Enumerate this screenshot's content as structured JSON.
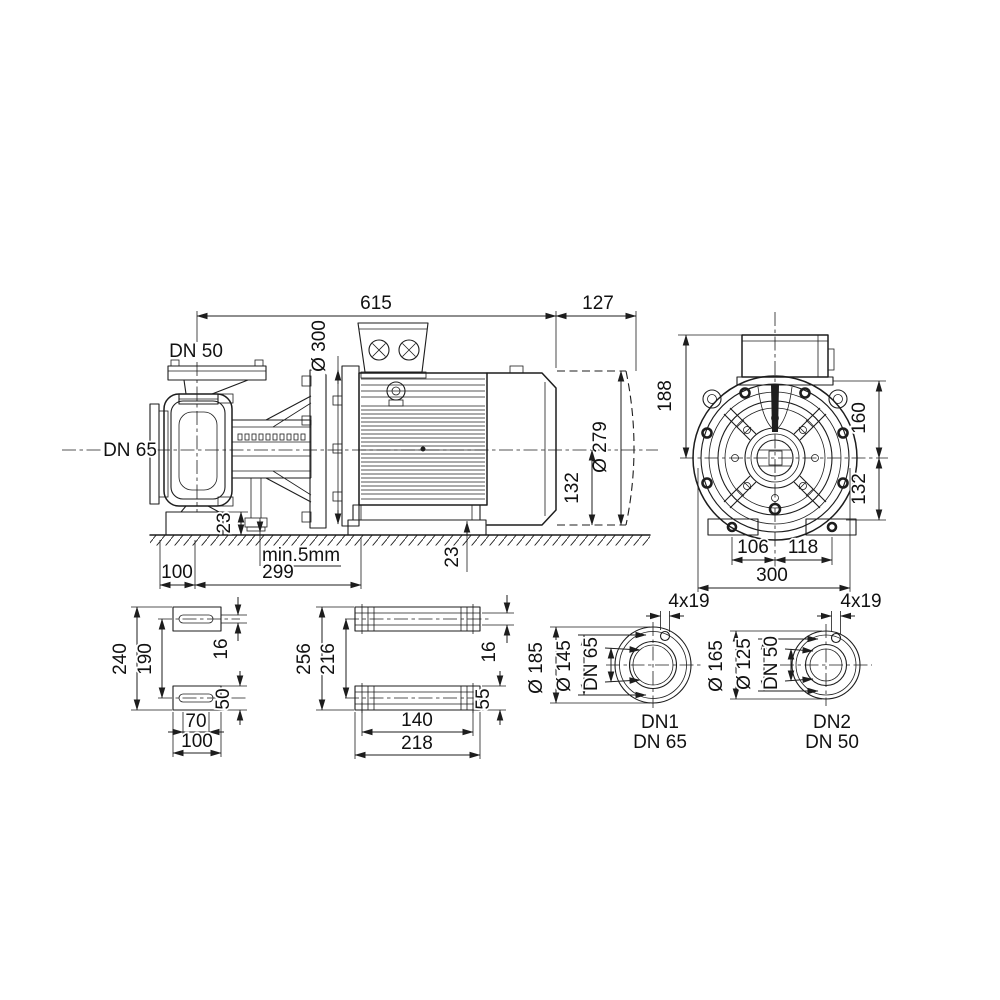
{
  "side_view": {
    "length_total": "615",
    "length_rear": "127",
    "discharge_label": "DN 50",
    "suction_label": "DN 65",
    "flange_dia": "Ø 300",
    "motor_dia": "Ø 279",
    "shaft_height": "132",
    "foot_block_height": "23",
    "motor_pad_height": "23",
    "grout_note": "min.5mm",
    "foot_offset": "100",
    "foot_span": "299"
  },
  "end_view": {
    "box_top_to_center": "188",
    "flange_face_to_center": "160",
    "center_to_foot": "132",
    "foot_left": "106",
    "foot_right": "118",
    "overall_width": "300"
  },
  "pump_foot_view": {
    "overall_length": "240",
    "hole_spacing": "190",
    "slot_width": "16",
    "foot_width": "50",
    "slot_length": "70",
    "overall_width": "100"
  },
  "motor_foot_view": {
    "overall_length": "256",
    "hole_spacing": "216",
    "slot_width": "16",
    "foot_width": "55",
    "hole_spacing_x": "140",
    "overall_width": "218"
  },
  "flange_dn1": {
    "bolt_holes": "4x19",
    "outer_dia": "Ø 185",
    "bolt_circle_dia": "Ø 145",
    "nominal_dia": "DN 65",
    "name": "DN1",
    "size": "DN 65"
  },
  "flange_dn2": {
    "bolt_holes": "4x19",
    "outer_dia": "Ø 165",
    "bolt_circle_dia": "Ø 125",
    "nominal_dia": "DN 50",
    "name": "DN2",
    "size": "DN 50"
  }
}
